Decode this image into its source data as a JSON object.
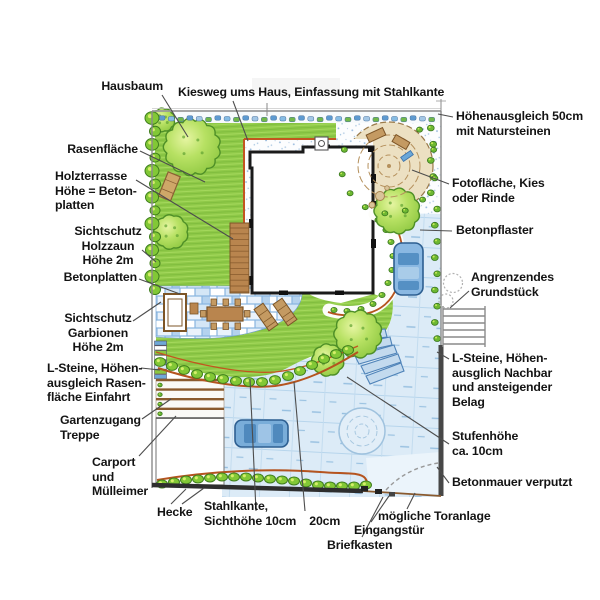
{
  "page": {
    "title": "Gartenplan – handgezeichneter Landschaftsplan",
    "width": 600,
    "height": 600,
    "background": "#ffffff"
  },
  "palette": {
    "label_text": "#141414",
    "leader_line": "#4d4d4d",
    "lawn_green": "#8fc948",
    "tree_green": "#9ed24f",
    "hedge_green": "#82c836",
    "gravel_white": "#fcfdfe",
    "paving_blue": "#88b5e0",
    "driveway_blue": "#dcebf7",
    "kies_tan": "#ece0c2",
    "wood_brown": "#b9854e",
    "steel_edge_red": "#c2561f",
    "wall_dark": "#3f3f3f",
    "car_blue": "#7fb0dc"
  },
  "plan": {
    "type": "garden landscape plan, top view, colored pencil style",
    "features": [
      "house",
      "lawn",
      "gravel path",
      "wood terrace",
      "patio",
      "driveway",
      "carport",
      "hedges",
      "photo gravel circle",
      "turning circle",
      "two cars",
      "garden steps",
      "entrance with mailbox"
    ]
  },
  "labels": [
    {
      "id": "hausbaum",
      "lines": [
        "Hausbaum"
      ],
      "x": 163,
      "y": 79,
      "align": "right",
      "leaders": [
        [
          162,
          95,
          188,
          137
        ]
      ]
    },
    {
      "id": "kiesweg",
      "lines": [
        "Kiesweg ums Haus, Einfassung mit Stahlkante"
      ],
      "x": 178,
      "y": 85,
      "align": "left",
      "leaders": [
        [
          233,
          101,
          248,
          141
        ]
      ]
    },
    {
      "id": "hoehenausgleich",
      "lines": [
        "Höhenausgleich 50cm",
        "mit Natursteinen"
      ],
      "x": 456,
      "y": 109,
      "align": "left",
      "leaders": [
        [
          453,
          117,
          438,
          114
        ]
      ]
    },
    {
      "id": "rasenflaeche",
      "lines": [
        "Rasenfläche"
      ],
      "x": 138,
      "y": 142,
      "align": "right",
      "leaders": [
        [
          140,
          151,
          205,
          182
        ]
      ]
    },
    {
      "id": "holzterrasse",
      "lines": [
        "Holzterrasse",
        "Höhe = Beton-",
        "platten"
      ],
      "x": 55,
      "y": 169,
      "align": "left",
      "leaders": [
        [
          136,
          180,
          233,
          239
        ]
      ]
    },
    {
      "id": "fotoflaeche",
      "lines": [
        "Fotofläche, Kies",
        "oder Rinde"
      ],
      "x": 452,
      "y": 176,
      "align": "left",
      "leaders": [
        [
          449,
          184,
          412,
          170
        ]
      ]
    },
    {
      "id": "sichtschutz-holzzaun",
      "lines": [
        "Sichtschutz",
        "Holzzaun",
        "Höhe 2m"
      ],
      "x": 108,
      "y": 224,
      "align": "center",
      "leaders": [
        [
          142,
          250,
          156,
          262
        ]
      ]
    },
    {
      "id": "betonpflaster",
      "lines": [
        "Betonpflaster"
      ],
      "x": 456,
      "y": 223,
      "align": "left",
      "leaders": [
        [
          452,
          231,
          420,
          230
        ]
      ]
    },
    {
      "id": "betonplatten",
      "lines": [
        "Betonplatten"
      ],
      "x": 137,
      "y": 270,
      "align": "right",
      "leaders": [
        [
          139,
          279,
          180,
          294
        ]
      ]
    },
    {
      "id": "angrenzendes-grundstueck",
      "lines": [
        "Angrenzendes",
        "Grundstück"
      ],
      "x": 471,
      "y": 270,
      "align": "left",
      "leaders": [
        [
          469,
          291,
          450,
          308
        ]
      ]
    },
    {
      "id": "sichtschutz-garbionen",
      "lines": [
        "Sichtschutz",
        "Garbionen",
        "Höhe 2m"
      ],
      "x": 98,
      "y": 311,
      "align": "center",
      "leaders": [
        [
          133,
          321,
          161,
          302
        ]
      ]
    },
    {
      "id": "l-steine-links",
      "lines": [
        "L-Steine, Höhen-",
        "ausgleich Rasen-",
        "fläche Einfahrt"
      ],
      "x": 47,
      "y": 361,
      "align": "left",
      "leaders": [
        [
          141,
          368,
          160,
          370
        ]
      ]
    },
    {
      "id": "l-steine-rechts",
      "lines": [
        "L-Steine, Höhen-",
        "ausglich Nachbar",
        "und ansteigender",
        "Belag"
      ],
      "x": 452,
      "y": 351,
      "align": "left",
      "leaders": [
        [
          449,
          359,
          437,
          352
        ]
      ]
    },
    {
      "id": "gartenzugang",
      "lines": [
        "Gartenzugang",
        "Treppe"
      ],
      "x": 60,
      "y": 413,
      "align": "left",
      "leaders": [
        [
          142,
          419,
          171,
          399
        ]
      ]
    },
    {
      "id": "stufenhoehe",
      "lines": [
        "Stufenhöhe",
        "ca. 10cm"
      ],
      "x": 452,
      "y": 429,
      "align": "left",
      "leaders": [
        [
          449,
          444,
          347,
          377
        ]
      ]
    },
    {
      "id": "carport",
      "lines": [
        "Carport",
        "und",
        "Mülleimer"
      ],
      "x": 92,
      "y": 455,
      "align": "left",
      "leaders": [
        [
          139,
          456,
          176,
          416
        ]
      ]
    },
    {
      "id": "betonmauer",
      "lines": [
        "Betonmauer verputzt"
      ],
      "x": 452,
      "y": 475,
      "align": "left",
      "leaders": [
        [
          449,
          483,
          437,
          467
        ]
      ]
    },
    {
      "id": "hecke",
      "lines": [
        "Hecke"
      ],
      "x": 157,
      "y": 505,
      "align": "left",
      "leaders": [
        [
          171,
          504,
          186,
          489
        ],
        [
          182,
          504,
          204,
          488
        ]
      ]
    },
    {
      "id": "stahlkante",
      "lines": [
        "Stahlkante,",
        "Sichthöhe 10cm    20cm"
      ],
      "x": 204,
      "y": 499,
      "align": "left",
      "leaders": [
        [
          256,
          511,
          250,
          379
        ],
        [
          305,
          511,
          294,
          382
        ]
      ]
    },
    {
      "id": "briefkasten",
      "lines": [
        "Briefkasten"
      ],
      "x": 327,
      "y": 538,
      "align": "left",
      "leaders": [
        [
          362,
          537,
          383,
          497
        ]
      ]
    },
    {
      "id": "eingangstuer",
      "lines": [
        "Eingangstür"
      ],
      "x": 354,
      "y": 523,
      "align": "left",
      "leaders": [
        [
          371,
          522,
          389,
          496
        ]
      ]
    },
    {
      "id": "toranlage",
      "lines": [
        "mögliche Toranlage"
      ],
      "x": 378,
      "y": 509,
      "align": "left",
      "leaders": [
        [
          407,
          509,
          415,
          493
        ]
      ]
    }
  ]
}
